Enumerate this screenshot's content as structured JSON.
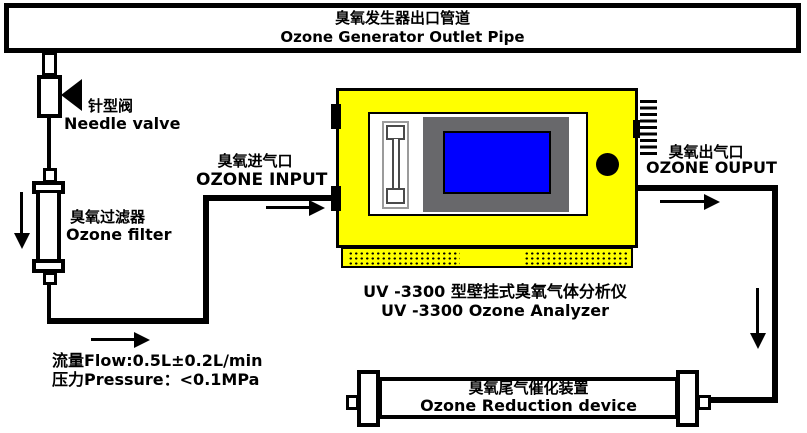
{
  "title_box": {
    "line_zh": "臭氧发生器出口管道",
    "line_en": "Ozone Generator Outlet Pipe"
  },
  "needle_valve": {
    "label_zh": "针型阀",
    "label_en": "Needle valve"
  },
  "ozone_filter": {
    "label_zh": "臭氧过滤器",
    "label_en": "Ozone filter"
  },
  "input_port": {
    "label_zh": "臭氧进气口",
    "label_en": "OZONE INPUT"
  },
  "output_port": {
    "label_zh": "臭氧出气口",
    "label_en": "OZONE OUPUT"
  },
  "analyzer": {
    "caption_zh": "UV -3300 型壁挂式臭氧气体分析仪",
    "caption_en": "UV -3300 Ozone Analyzer"
  },
  "specs": {
    "flow": "流量Flow:0.5L±0.2L/min",
    "pressure": "压力Pressure：<0.1MPa"
  },
  "reduction_device": {
    "label_zh": "臭氧尾气催化装置",
    "label_en": "Ozone Reduction device"
  },
  "colors": {
    "analyzer_body": "#FFFF00",
    "screen_blue": "#0000FF",
    "bezel_gray": "#68686B",
    "line_black": "#000000"
  }
}
